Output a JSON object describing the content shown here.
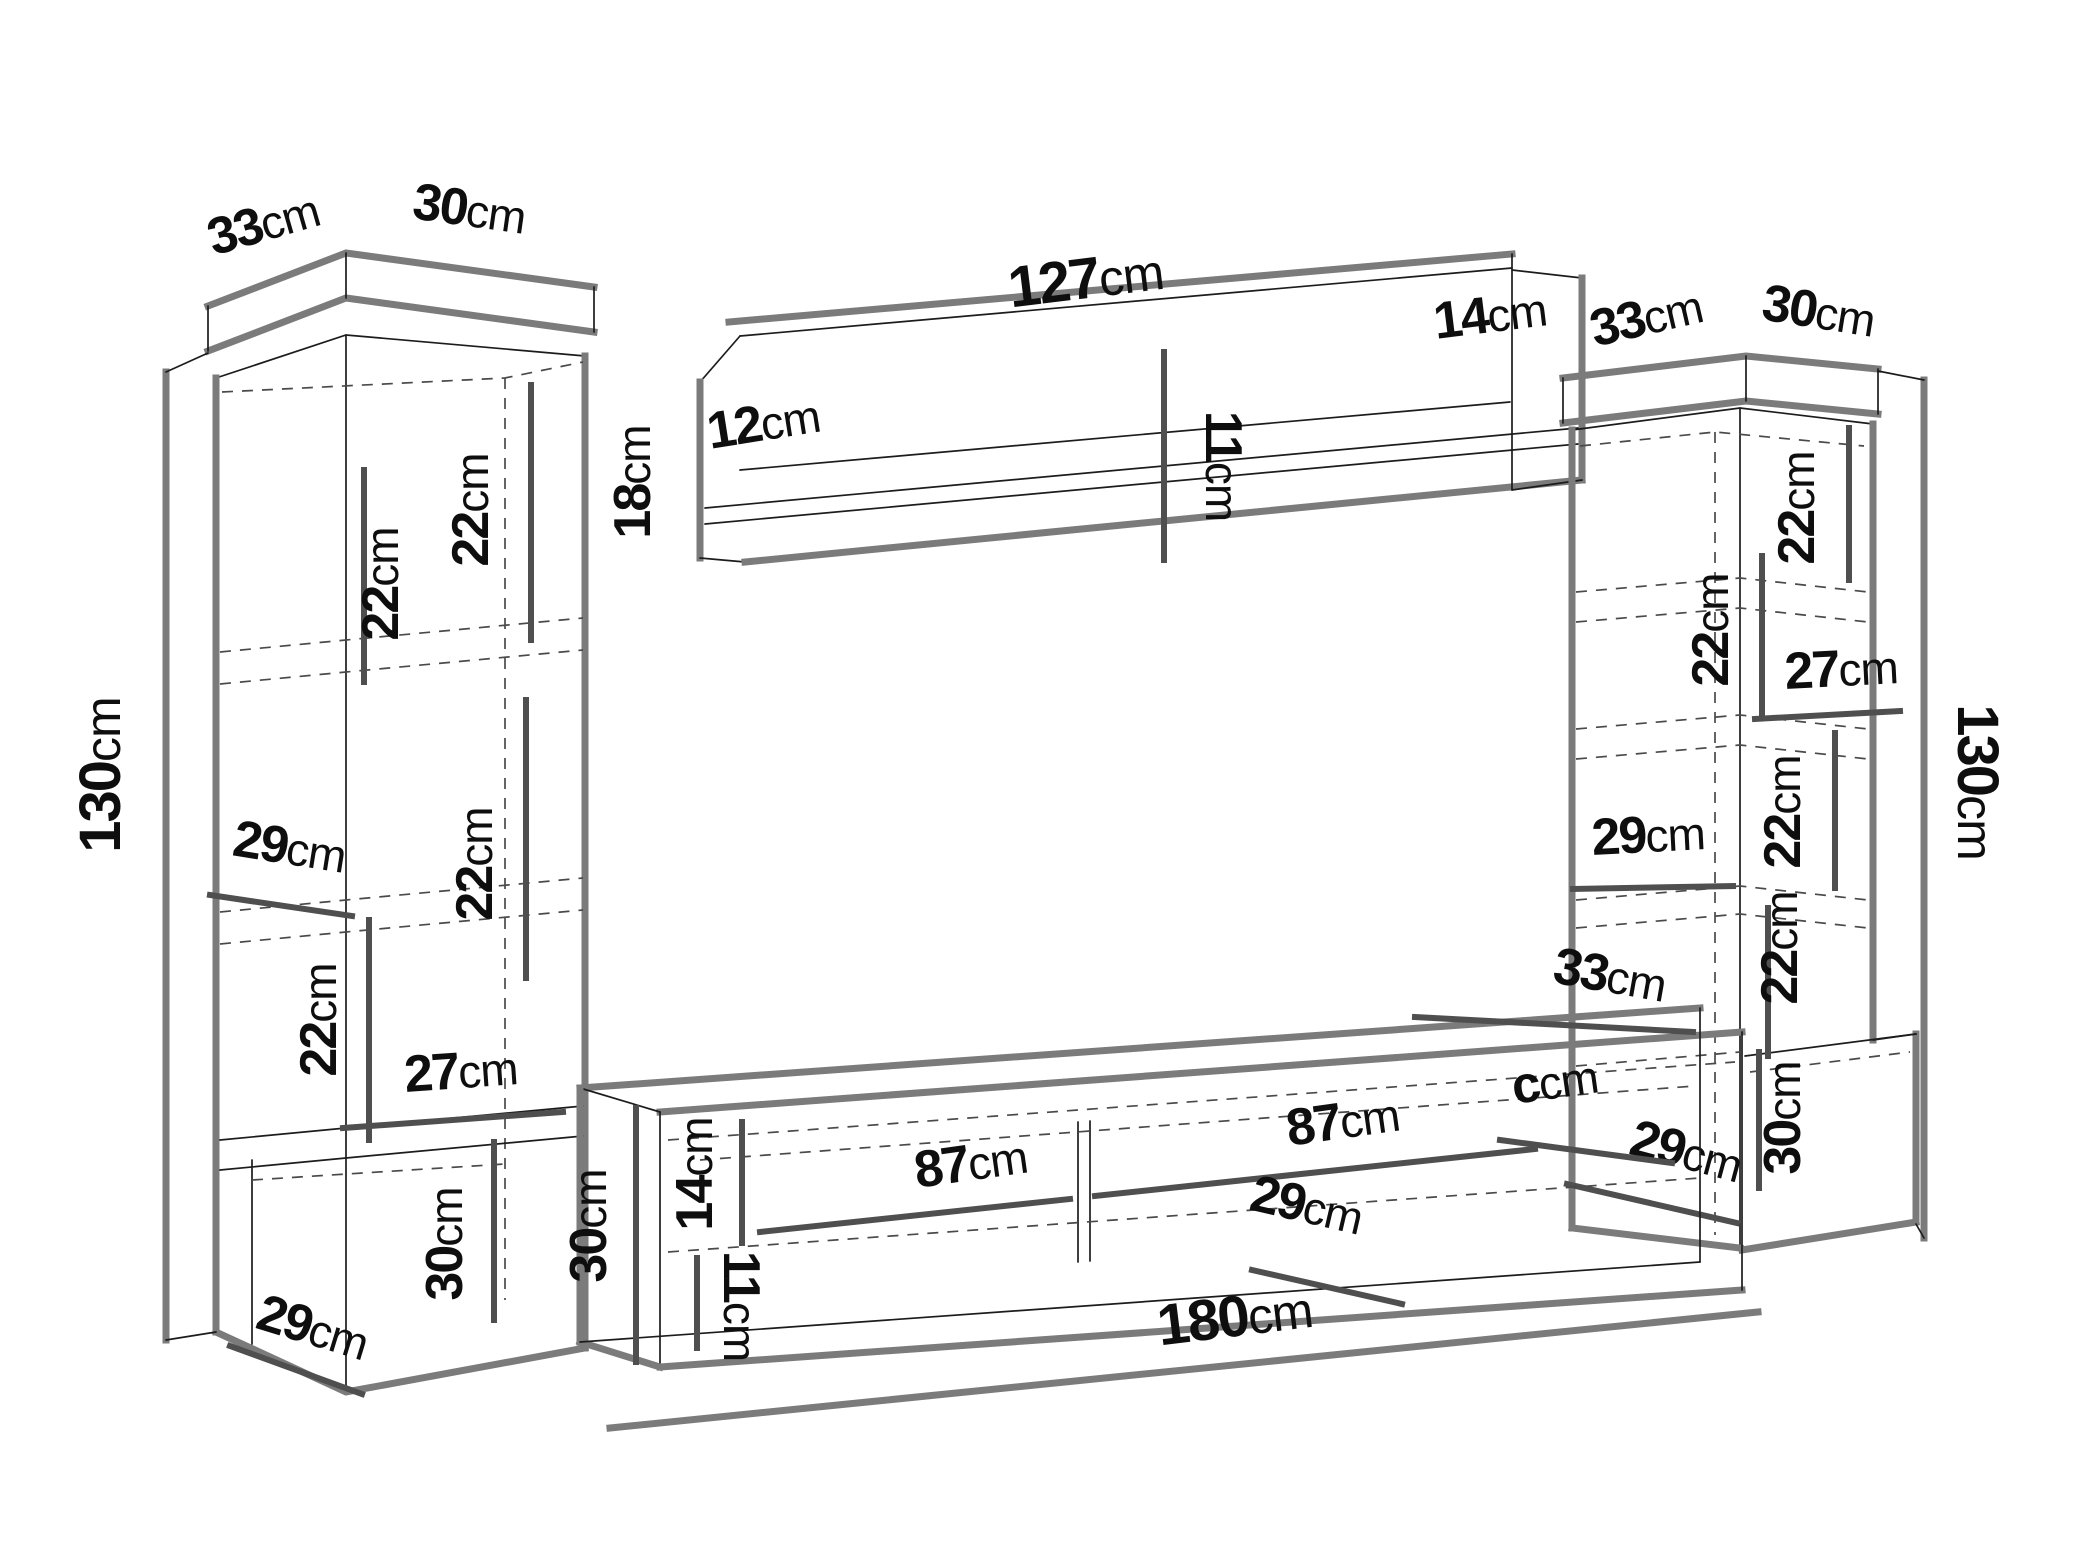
{
  "unit": "cm",
  "diagram": {
    "description": "Isometric dimension diagram of a TV wall unit set: two tall display cabinets, a wall shelf and a TV stand",
    "edge_color": "#7b7b7b",
    "line_color": "#1c1c1c",
    "text_color": "#0e0e0e",
    "background": "#ffffff"
  },
  "left_cabinet": {
    "top_depth": "33",
    "top_width": "30",
    "height": "130",
    "shelf_gap_top": "22",
    "shelf_gap_upper": "22",
    "shelf_gap_middle": "22",
    "interior_width": "29",
    "shelf_gap_lower": "22",
    "niche_width": "27",
    "base_height": "30",
    "base_depth": "29"
  },
  "wall_shelf": {
    "length": "127",
    "end_height": "14",
    "height": "18",
    "depth": "12",
    "lip_height": "11"
  },
  "right_cabinet": {
    "top_depth": "33",
    "top_width": "30",
    "height": "130",
    "shelf_gap_top": "22",
    "shelf_gap_upper": "22",
    "niche_width": "27",
    "shelf_gap_middle": "22",
    "interior_width": "29",
    "shelf_gap_lower": "22",
    "base_height": "30",
    "base_depth": "29"
  },
  "tv_stand": {
    "depth": "33",
    "end_height": "30",
    "opening_height": "14",
    "lip_height": "11",
    "compartment_left_width": "87",
    "compartment_right_width": "87",
    "shelf_depth": "29",
    "marker": "c",
    "length": "180"
  }
}
